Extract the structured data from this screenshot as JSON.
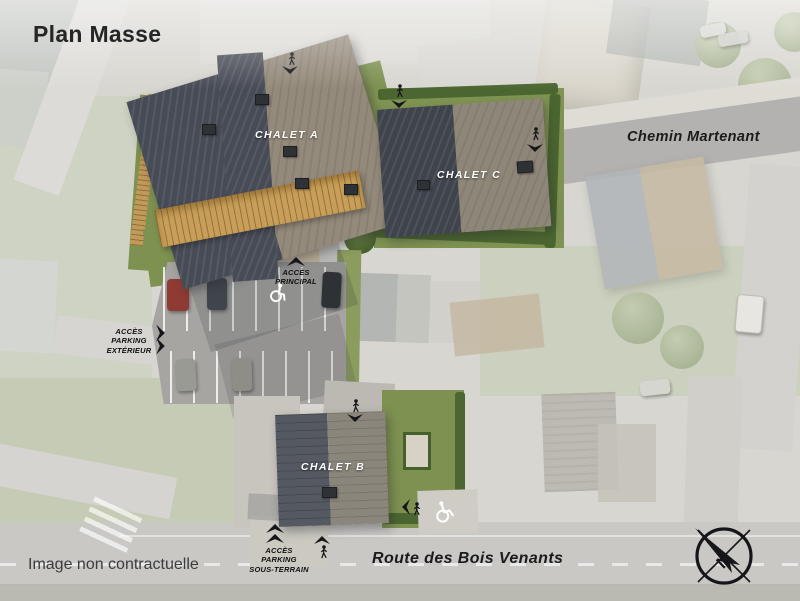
{
  "page": {
    "title": "Plan Masse",
    "disclaimer": "Image non contractuelle"
  },
  "buildings": {
    "chalet_a": {
      "label": "CHALET A"
    },
    "chalet_b": {
      "label": "CHALET B"
    },
    "chalet_c": {
      "label": "CHALET C"
    }
  },
  "roads": {
    "chemin_martenant": {
      "label": "Chemin Martenant"
    },
    "route_des_bois_venants": {
      "label": "Route des Bois Venants"
    }
  },
  "access": {
    "principal": {
      "label": "ACCÈS\nPRINCIPAL"
    },
    "parking_exterieur": {
      "label": "ACCÈS\nPARKING\nEXTÉRIEUR"
    },
    "parking_sous_terrain": {
      "label": "ACCÈS\nPARKING\nSOUS-TERRAIN"
    }
  },
  "compass": {
    "north_label": "N"
  },
  "icons": {
    "pedestrian": "black walking-person access marker",
    "direction_arrow": "black notched triangle arrow",
    "wheelchair": "white accessible-parking road marking",
    "compass_rose": "circle with crosshair and north needle"
  },
  "colors": {
    "roof_dark": "#474b55",
    "roof_light": "#948a7b",
    "lawn_green": "#7d9150",
    "hedge_green": "#4b6630",
    "wood_balcony": "#c79f58",
    "parking_asphalt": "#a7a5a1",
    "label_text": "#141414",
    "chalet_label": "#ffffff"
  }
}
